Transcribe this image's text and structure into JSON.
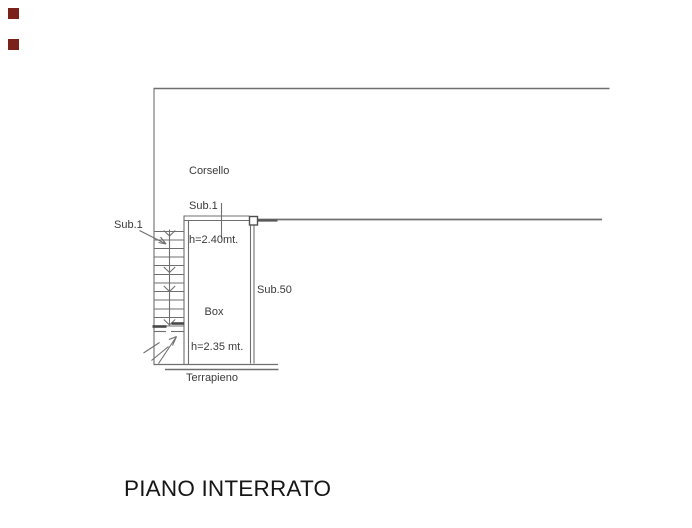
{
  "plan": {
    "title": "PIANO INTERRATO",
    "corsello": {
      "name": "Corsello",
      "sub": "Sub.1",
      "height": "h=2.40mt."
    },
    "stairs": {
      "sub": "Sub.1"
    },
    "box": {
      "name": "Box",
      "height": "h=2.35 mt."
    },
    "sub50": "Sub.50",
    "terrapieno": "Terrapieno",
    "colors": {
      "line": "#6f6f6f",
      "line_bold": "#474747",
      "text": "#3a3a3a",
      "title": "#161616",
      "marker": "#7b211a",
      "background": "#ffffff"
    }
  }
}
